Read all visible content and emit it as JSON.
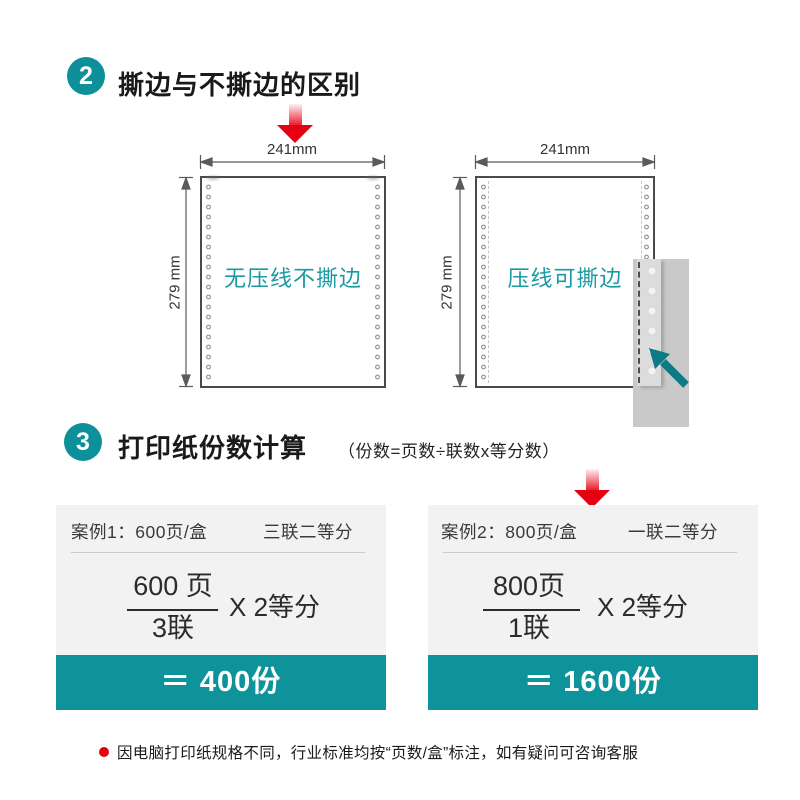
{
  "colors": {
    "accent_teal": "#0d9099",
    "accent_red": "#e60012",
    "card_bg": "#f2f2f2",
    "paper_label_teal": "#1a9aa2"
  },
  "section_tear": {
    "badge": "2",
    "title": "撕边与不撕边的区别",
    "paper_left": {
      "width_label": "241mm",
      "height_label": "279 mm",
      "label": "无压线不撕边"
    },
    "paper_right": {
      "width_label": "241mm",
      "height_label": "279 mm",
      "label": "压线可撕边"
    }
  },
  "section_calc": {
    "badge": "3",
    "title": "打印纸份数计算",
    "formula": "（份数=页数÷联数x等分数）",
    "cases": [
      {
        "name_spec": "案例1：600页/盒",
        "layout": "三联二等分",
        "numerator": "600 页",
        "denominator": "3联",
        "multiplier": "X 2等分",
        "result": "＝ 400份"
      },
      {
        "name_spec": "案例2：800页/盒",
        "layout": "一联二等分",
        "numerator": "800页",
        "denominator": "1联",
        "multiplier": "X 2等分",
        "result": "＝ 1600份"
      }
    ]
  },
  "footnote": "因电脑打印纸规格不同，行业标准均按“页数/盒”标注，如有疑问可咨询客服"
}
